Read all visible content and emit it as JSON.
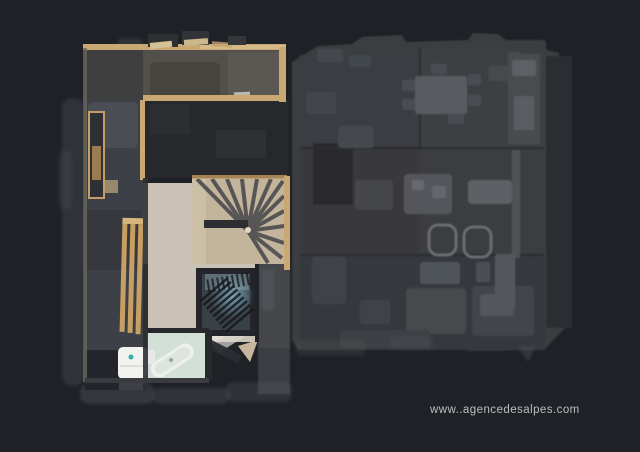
{
  "watermark": {
    "text": "www..agencedesalpes.com"
  },
  "palette": {
    "background": "#1e2126",
    "unlit_floor": "#3a3c41",
    "unlit_wall_band": "#2b2d30",
    "unlit_furniture": "#54575c",
    "lit_hall_floor": "#53504b",
    "lit_corridor_floor": "#3e4047",
    "wood_wall": "#c9a873",
    "bench_wood": "#c79f62",
    "stair_wood": "#c2b59b",
    "stair_tread": "#454549",
    "room_wood_floor": "#cac2b6",
    "bathroom_floor": "#d2e0d8",
    "appliance_white": "#f2f2f0",
    "stairwell_glow": "#7fb3cc",
    "watermark_text": "#c7c9cb"
  }
}
